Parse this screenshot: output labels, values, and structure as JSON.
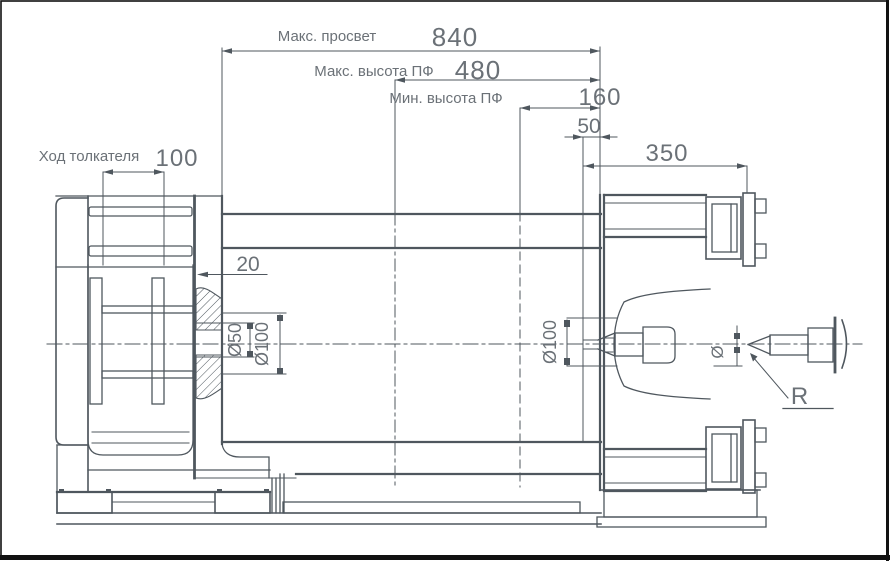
{
  "colors": {
    "line": "#4f575e",
    "text": "#6b7177",
    "background": "#ffffff",
    "frame": "#111111"
  },
  "dimensions": {
    "max_clearance": {
      "label": "Макс. просвет",
      "value": "840"
    },
    "max_mold_height": {
      "label": "Макс. высота ПФ",
      "value": "480"
    },
    "min_mold_height": {
      "label": "Мин. высота ПФ",
      "value": "160"
    },
    "nozzle_protrusion": {
      "value": "50"
    },
    "platen_span": {
      "value": "350"
    },
    "ejector_stroke": {
      "label": "Ход толкателя",
      "value": "100"
    },
    "plate_offset": {
      "value": "20"
    },
    "ejector_rod_diameter": {
      "value": "Ø50"
    },
    "ejector_hole_diameter": {
      "value": "Ø100"
    },
    "locating_hole_diameter": {
      "value": "Ø100"
    },
    "sprue_diameter_symbol": {
      "value": "Ø"
    },
    "nozzle_tip_radius": {
      "value": "R"
    }
  }
}
